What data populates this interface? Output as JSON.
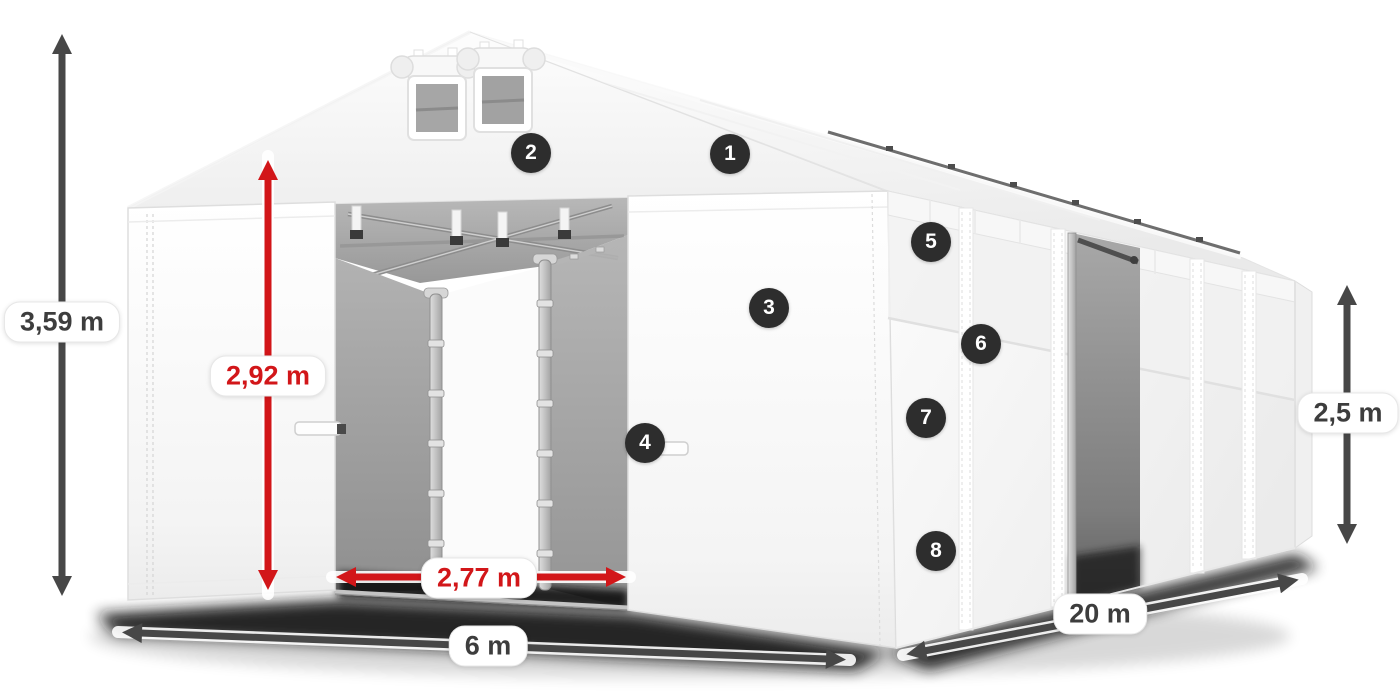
{
  "colors": {
    "accent_red": "#d21619",
    "dimension_dark": "#474747",
    "badge_background": "#2d2d2d",
    "badge_text": "#ffffff",
    "tent_white": "#ffffff",
    "interior_gray": "#a6a6a6"
  },
  "dimensions": {
    "total_height": {
      "label": "3,59 m"
    },
    "door_height": {
      "label": "2,92 m"
    },
    "door_width": {
      "label": "2,77 m"
    },
    "front_width": {
      "label": "6 m"
    },
    "side_length": {
      "label": "20 m"
    },
    "side_height": {
      "label": "2,5 m"
    }
  },
  "callouts": [
    {
      "number": "1"
    },
    {
      "number": "2"
    },
    {
      "number": "3"
    },
    {
      "number": "4"
    },
    {
      "number": "5"
    },
    {
      "number": "6"
    },
    {
      "number": "7"
    },
    {
      "number": "8"
    }
  ]
}
